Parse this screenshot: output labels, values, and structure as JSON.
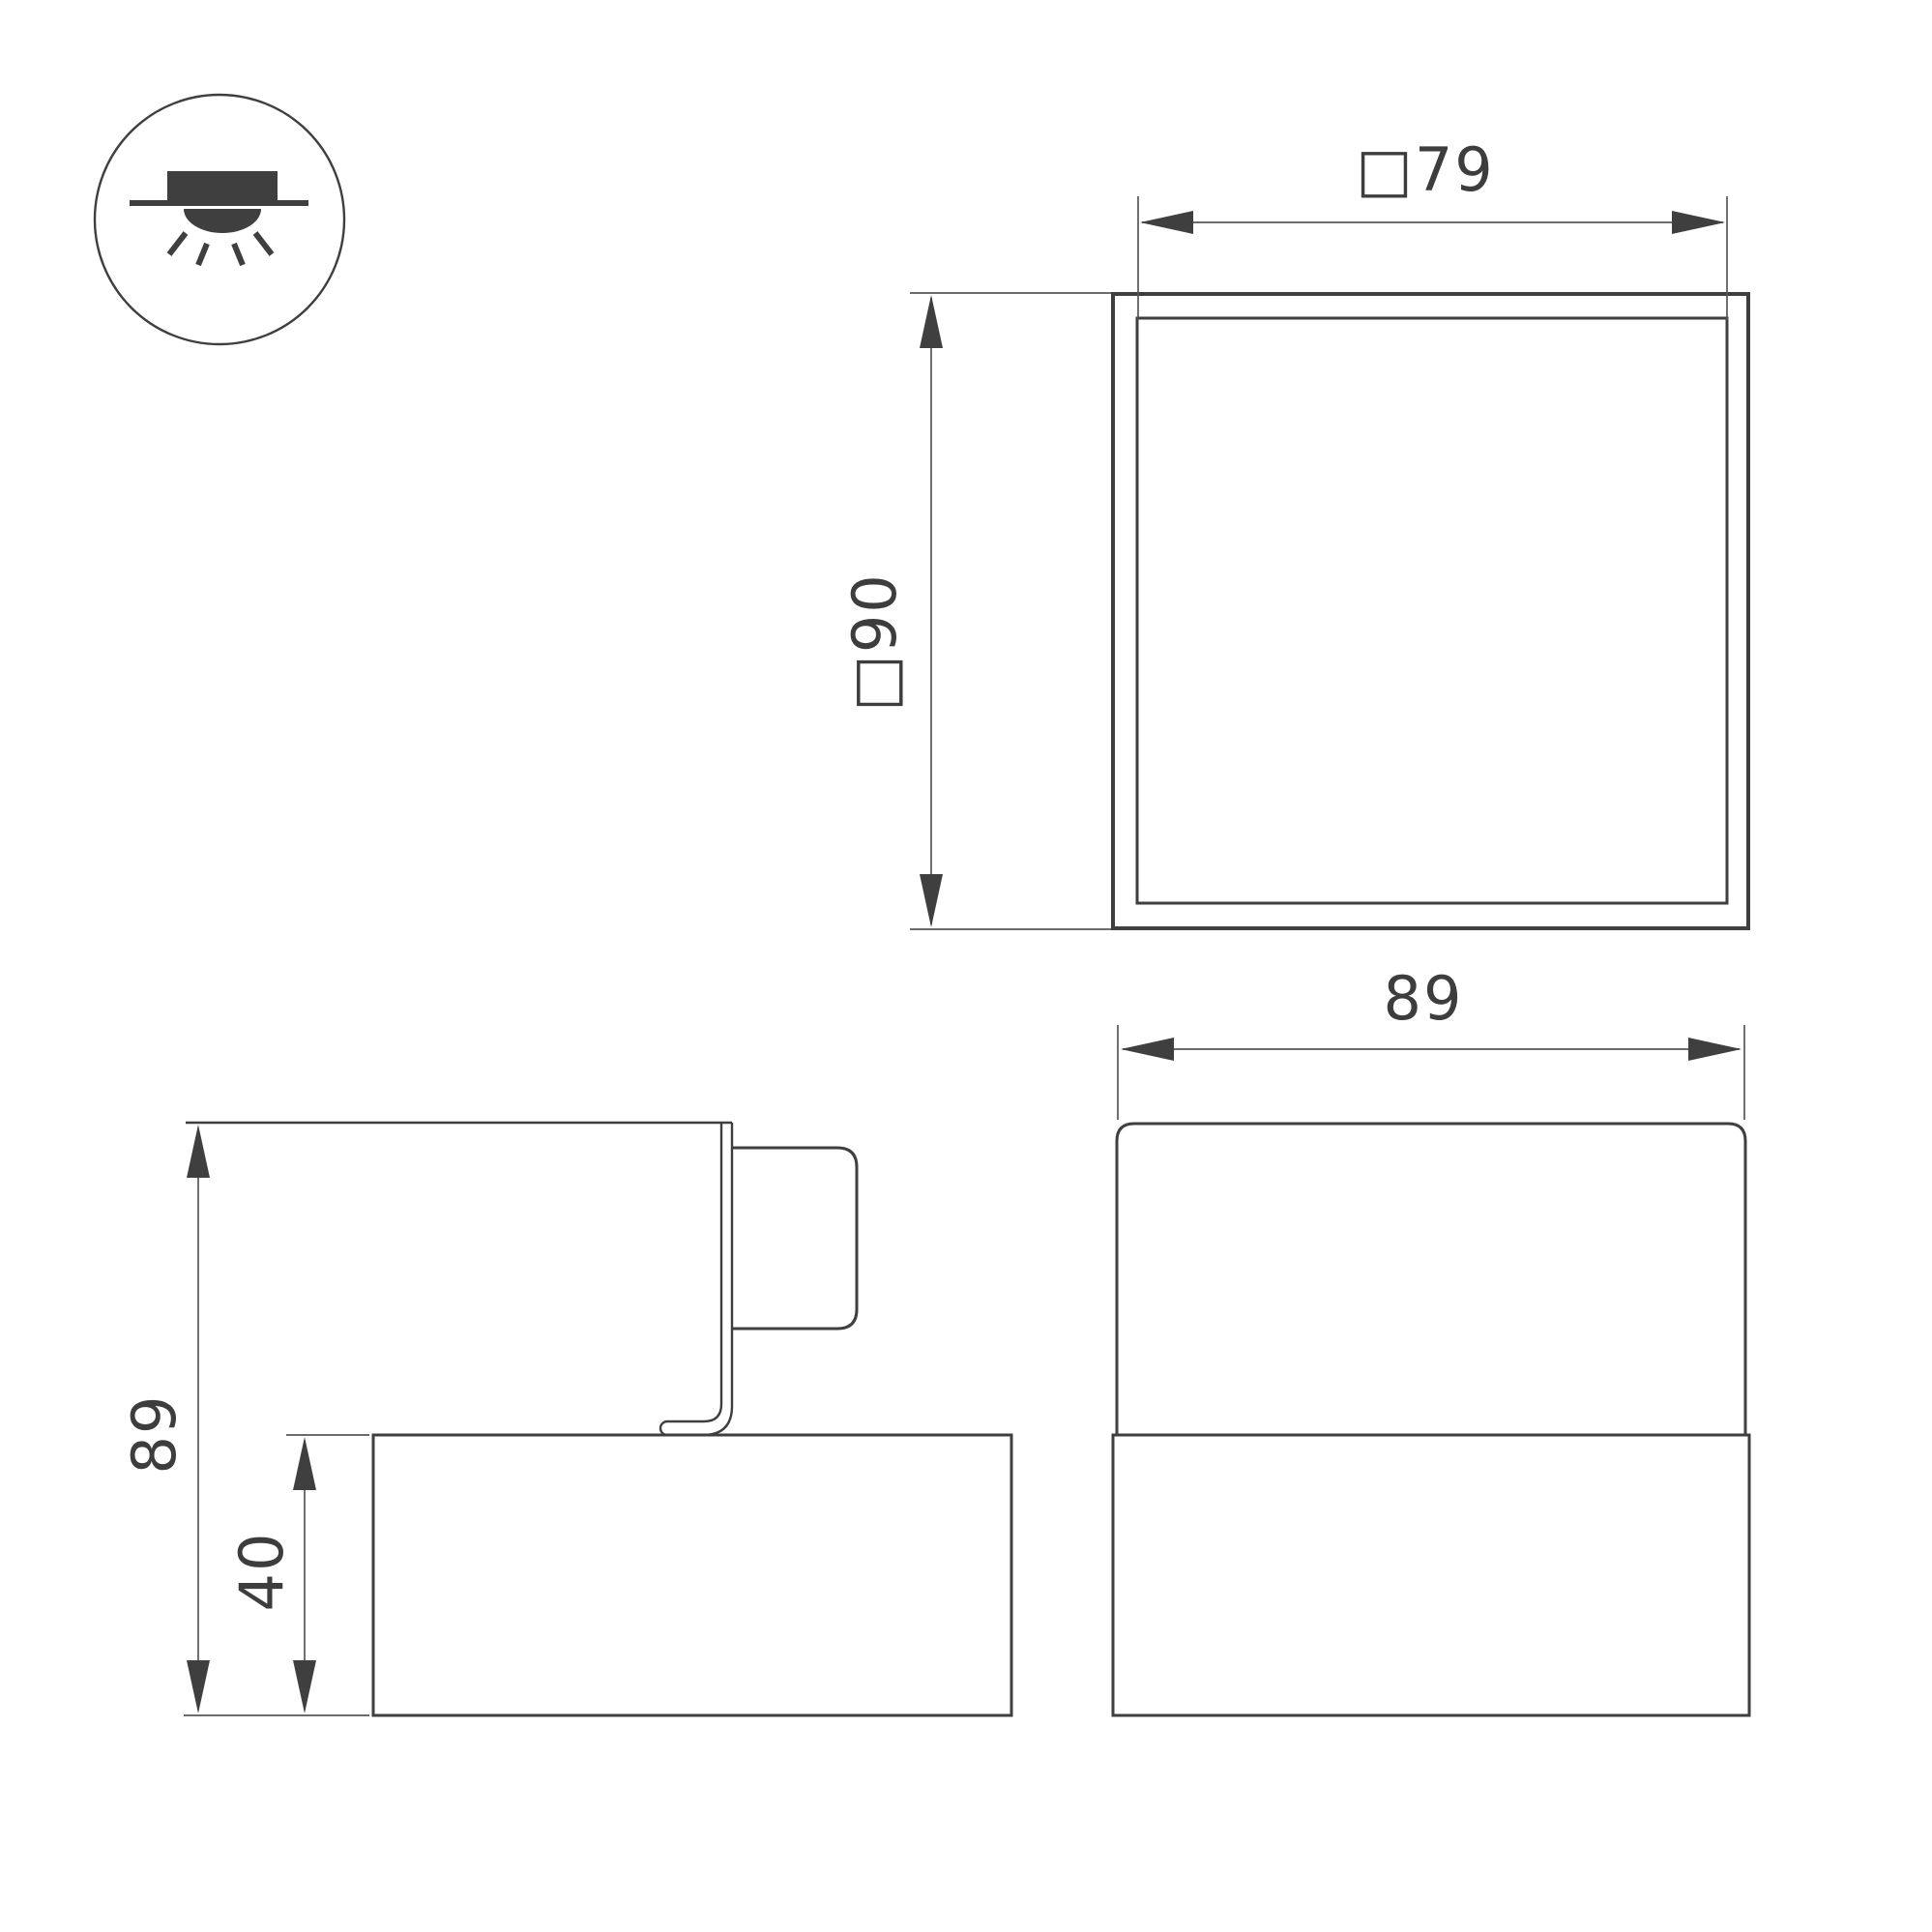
{
  "drawing": {
    "type": "luminaire-dimension-drawing",
    "mount_icon_meaning": "surface-mounted-light"
  },
  "views": {
    "top": {
      "name": "top-view",
      "width": {
        "label": "□79"
      },
      "height": {
        "label": "□90"
      }
    },
    "front": {
      "name": "front-view",
      "width": {
        "label": "89"
      }
    },
    "side": {
      "name": "side-view",
      "height": {
        "label": "89"
      },
      "base_height": {
        "label": "40"
      }
    }
  },
  "colors": {
    "background": "#ffffff",
    "line": "#3f3f3f",
    "dimension_line": "#565656",
    "text": "#3d3d3d"
  }
}
